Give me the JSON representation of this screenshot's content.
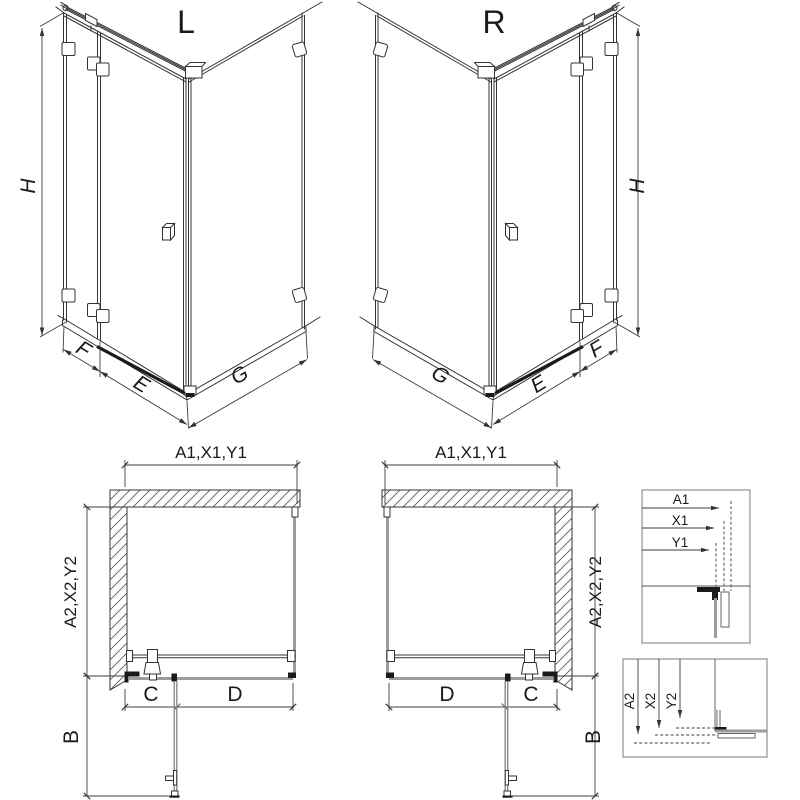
{
  "drawing": {
    "left": {
      "title": "L",
      "height": "H",
      "fixed_width": "F",
      "door_width": "E",
      "side_width": "G"
    },
    "right": {
      "title": "R",
      "height": "H",
      "fixed_width": "F",
      "door_width": "E",
      "side_width": "G"
    },
    "plan_left": {
      "width": "A1,X1,Y1",
      "depth": "A2,X2,Y2",
      "fixed": "C",
      "door": "D",
      "door_open": "B"
    },
    "plan_right": {
      "width": "A1,X1,Y1",
      "depth": "A2,X2,Y2",
      "fixed": "C",
      "door": "D",
      "door_open": "B"
    },
    "detail_width": {
      "a1": "A1",
      "x1": "X1",
      "y1": "Y1"
    },
    "detail_depth": {
      "a2": "A2",
      "x2": "X2",
      "y2": "Y2"
    }
  },
  "colors": {
    "line": "#333333",
    "dim": "#3d3d3d",
    "glass": "#9c9c9c",
    "dark": "#1a1a1a",
    "box_border": "#8f8f8f",
    "background": "#ffffff"
  }
}
